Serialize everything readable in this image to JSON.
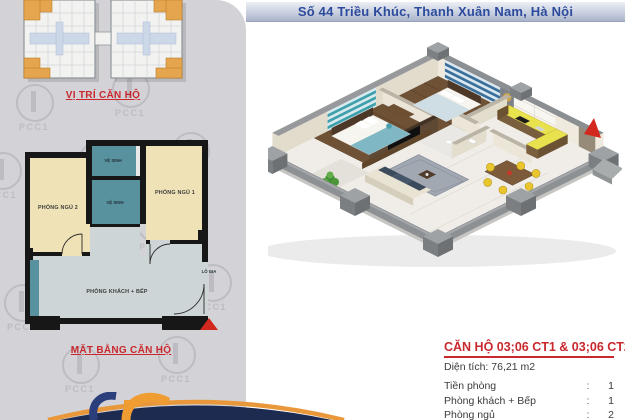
{
  "header": {
    "address": "Số 44 Triều Khúc, Thanh Xuân Nam, Hà Nội"
  },
  "branding": {
    "watermark": "PCC1"
  },
  "site_plan": {
    "label": "VỊ TRÍ CĂN HỘ"
  },
  "floor_plan": {
    "label": "MẶT BẰNG CĂN HỘ",
    "rooms": {
      "bedroom_2": "PHÒNG NGỦ 2",
      "bedroom_1": "PHÒNG NGỦ 1",
      "bathroom": "VỆ SINH",
      "living_kitchen": "PHÒNG KHÁCH + BẾP",
      "loggia": "LÔ GIA"
    }
  },
  "apartment_info": {
    "title": "CĂN HỘ 03;06 CT1 & 03;06 CT2",
    "area": "Diện tích: 76,21 m2",
    "separator": ":",
    "rows": [
      {
        "label": "Tiền phòng",
        "value": "1"
      },
      {
        "label": "Phòng khách + Bếp",
        "value": "1"
      },
      {
        "label": "Phòng ngủ",
        "value": "2"
      },
      {
        "label": "Vệ sinh",
        "value": "2"
      }
    ]
  },
  "colors": {
    "accent_red": "#c9282d",
    "header_text_blue": "#2d4b9c",
    "swoosh_navy": "#1e2b50",
    "swoosh_orange": "#e8973a",
    "highlight_unit_orange": "#e5a44e",
    "bedroom_cream": "#efe2b6",
    "bathroom_teal": "#59929f",
    "living_gray": "#ced5d6"
  }
}
